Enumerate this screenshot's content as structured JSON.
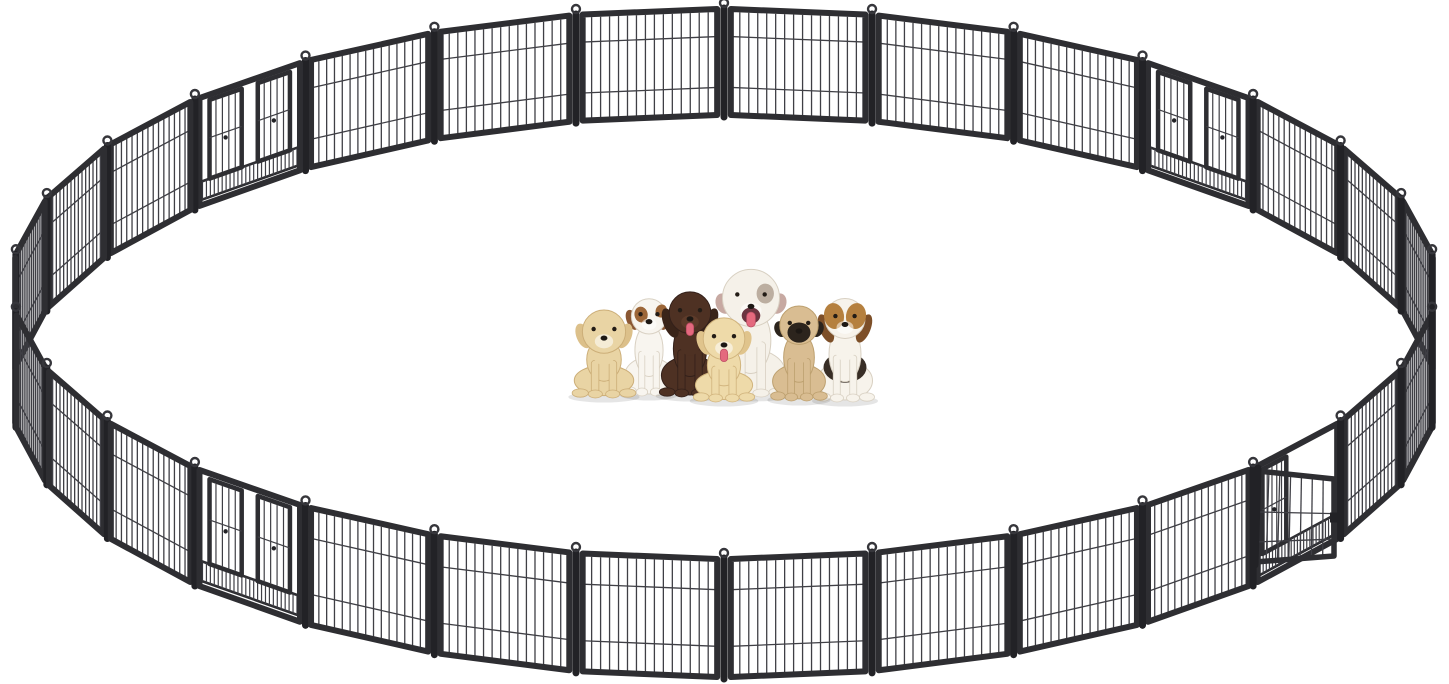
{
  "scene": {
    "description": "Large circular heavy-duty metal dog playpen made of hinged wire panels with four gate sections (one gate door open at lower right) and seven puppies sitting together in the center on a white background",
    "background": "#ffffff",
    "width": 1449,
    "height": 684
  },
  "geometry": {
    "center_x": 724,
    "center_y": 396,
    "radius_x": 712,
    "radius_y": 281,
    "panel_height": 112,
    "panel_height_perspective": 6
  },
  "playpen": {
    "panel_count": 30,
    "frame_color": "#2e2e32",
    "frame_dark": "#222226",
    "wire_color": "#3f3f45",
    "connector_ring_color": "#36363b",
    "vertical_wires_per_panel": 14,
    "horizontal_wire_fractions": [
      0.26,
      0.74
    ],
    "gates": [
      {
        "index": 3,
        "position": "upper-right",
        "state": "closed"
      },
      {
        "index": 10,
        "position": "lower-right",
        "state": "open-left"
      },
      {
        "index": 18,
        "position": "lower-left",
        "state": "closed"
      },
      {
        "index": 26,
        "position": "upper-left",
        "state": "closed"
      }
    ],
    "open_door": {
      "corners": [
        [
          1258,
          471
        ],
        [
          1334,
          479
        ],
        [
          1334,
          556
        ],
        [
          1255,
          562
        ]
      ],
      "bars": 6,
      "horizontal_fractions": [
        0.45,
        0.78
      ]
    }
  },
  "shadow_color": "rgba(0,0,0,0.10)",
  "dogs": [
    {
      "id": "jack-russell-terrier",
      "x": 649,
      "base_y": 392,
      "width": 44,
      "height": 97,
      "body": "#f8f5ef",
      "shade": "#d9d1c3",
      "ear": "#8a5733",
      "patch": "#9c6638",
      "style": "jack",
      "tongue": false
    },
    {
      "id": "chocolate-labrador",
      "x": 690,
      "base_y": 393,
      "width": 52,
      "height": 103,
      "body": "#4e3123",
      "shade": "#33201a",
      "ear": "#3a2419",
      "style": "lab",
      "tongue": true
    },
    {
      "id": "white-bulldog",
      "x": 751,
      "base_y": 393,
      "width": 62,
      "height": 122,
      "body": "#f5f1e9",
      "shade": "#d8d0c2",
      "ear": "#c7a9a2",
      "patch": "#8d7664",
      "style": "bulldog",
      "tongue": true
    },
    {
      "id": "beagle",
      "x": 845,
      "base_y": 398,
      "width": 50,
      "height": 102,
      "body": "#f7f3eb",
      "shade": "#d8d0c2",
      "ear": "#7d4f28",
      "patch": "#b5803f",
      "saddle": "#382e26",
      "style": "beagle",
      "tongue": false
    },
    {
      "id": "pug",
      "x": 799,
      "base_y": 397,
      "width": 48,
      "height": 92,
      "body": "#d9bd92",
      "shade": "#bda06f",
      "ear": "#2c241d",
      "mask": "#2c241d",
      "style": "pug",
      "tongue": false
    },
    {
      "id": "golden-puppy-left",
      "x": 604,
      "base_y": 394,
      "width": 54,
      "height": 80,
      "body": "#e9d4a4",
      "shade": "#ccae78",
      "ear": "#dcc08a",
      "style": "golden",
      "tongue": false
    },
    {
      "id": "golden-puppy-front",
      "x": 724,
      "base_y": 398,
      "width": 52,
      "height": 76,
      "body": "#eedaa9",
      "shade": "#d1b47d",
      "ear": "#e0c48c",
      "style": "golden",
      "tongue": true
    }
  ]
}
